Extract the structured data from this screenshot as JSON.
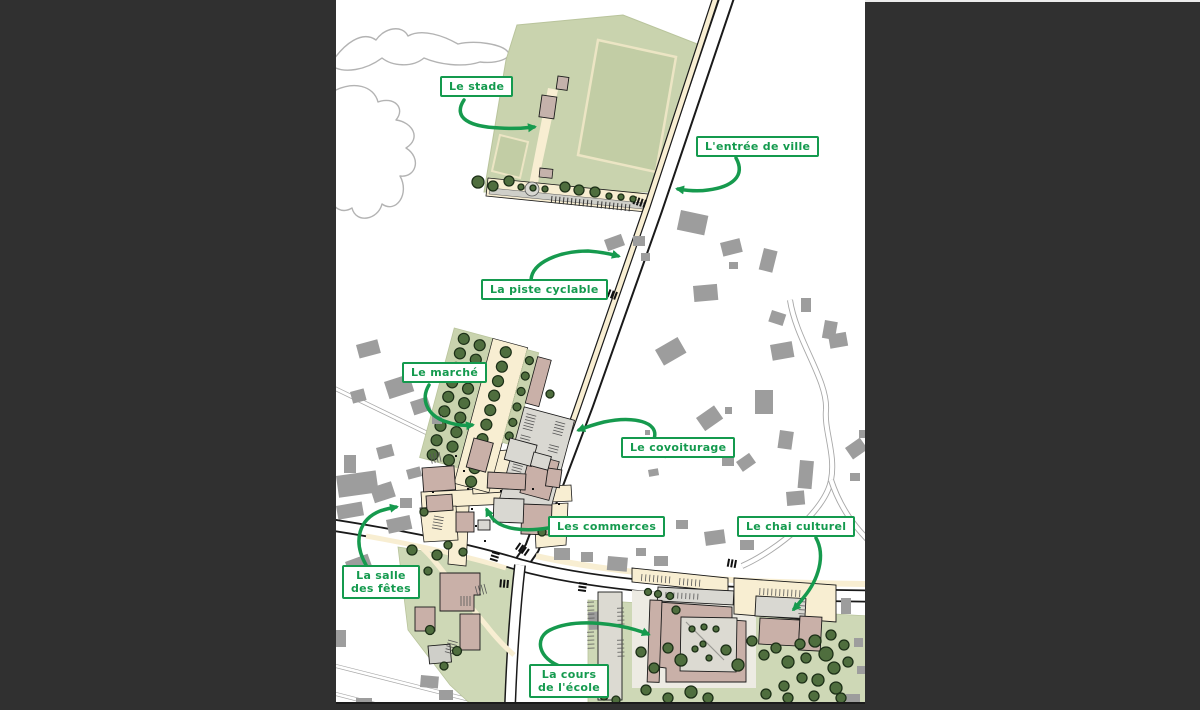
{
  "annotations": {
    "stade": "Le stade",
    "entree_de_ville": "L'entrée de ville",
    "piste_cyclable": "La piste cyclable",
    "marche": "Le marché",
    "covoiturage": "Le covoiturage",
    "commerces": "Les commerces",
    "chai_culturel": "Le chai culturel",
    "salle_des_fetes_line1": "La salle",
    "salle_des_fetes_line2": "des fêtes",
    "cours_ecole_line1": "La cours",
    "cours_ecole_line2": "de l'école"
  },
  "colors": {
    "accent_green": "#149a4e",
    "background": "#303030",
    "map_white": "#ffffff",
    "stadium_green": "#c9d3ae",
    "park_green": "#ced8b6",
    "street_cream": "#f8eed2",
    "existing_building_gray": "#9d9d9d",
    "project_building_pink": "#c9b0a8",
    "light_building_gray": "#d9d8d2",
    "tree_green": "#4f6e3e"
  }
}
